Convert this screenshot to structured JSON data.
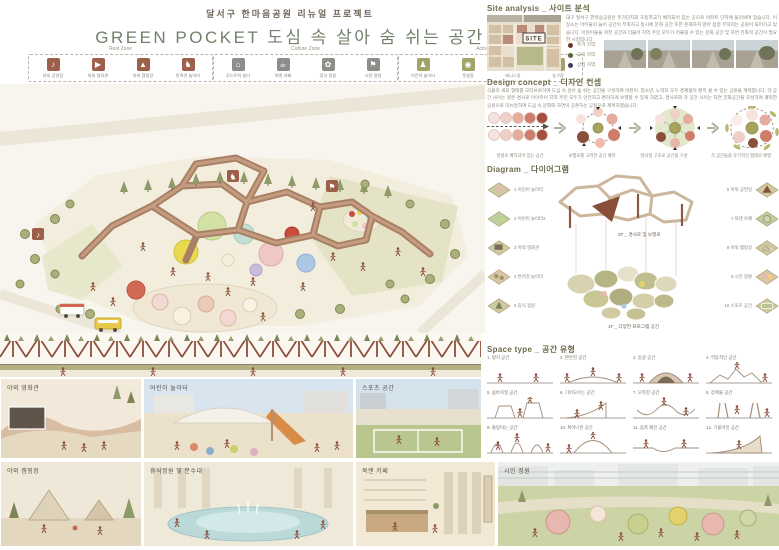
{
  "title": {
    "subtitle": "달서구 한마음공원 리뉴얼 프로젝트",
    "main": "GREEN POCKET  도심 속 살아 숨 쉬는 공간"
  },
  "colors": {
    "title_green": "#72806a",
    "rest_zone_accent": "#9c5f4a",
    "culture_zone_accent": "#8f8d89",
    "activity_zone_accent": "#a3a368",
    "legend_residential": "#6e3430",
    "legend_education": "#55673f",
    "legend_commercial": "#3f4063"
  },
  "zones": [
    {
      "name": "Rest Zone",
      "items": [
        {
          "label": "야외 공연장",
          "glyph": "♪"
        },
        {
          "label": "야외 영화관",
          "glyph": "▶"
        },
        {
          "label": "야외 캠핑장",
          "glyph": "▲"
        },
        {
          "label": "반려견 놀이터",
          "glyph": "♞"
        }
      ]
    },
    {
      "name": "Culture Zone",
      "items": [
        {
          "label": "푸드트럭 쉼터",
          "glyph": "⌂"
        },
        {
          "label": "북앤 카페",
          "glyph": "☕"
        },
        {
          "label": "휴식 정원",
          "glyph": "✿"
        },
        {
          "label": "시민 정원",
          "glyph": "⚑"
        }
      ]
    },
    {
      "name": "Activity Zone",
      "items": [
        {
          "label": "어린이 놀이터",
          "glyph": "♟"
        },
        {
          "label": "풋살장",
          "glyph": "◉"
        },
        {
          "label": "테니스장",
          "glyph": "✶"
        },
        {
          "label": "농구장",
          "glyph": "◍"
        }
      ]
    }
  ],
  "site_analysis": {
    "header": "Site analysis _ 사이트 분석",
    "site_label": "SITE",
    "text": "대구 달서구 한마음공원은 주거단지와 초등학교가 배치되어 있는 곳으로 아파트 단지에 둘러싸여 있습니다. 이 장소는 아이들의 놀이 공간이 부족하고 동시에 문화 공간 또한 존재하지 않아 점점 무뎌지는 공원이 되어가고 있습니다. 어린이들을 위한 공간과 더불어 지역 주민 모두가 어울릴 수 있는 문화 공간 및 자연 친화적 공간이 필요한 시점입니다.",
    "legend": [
      {
        "label": "주거 지역",
        "color": "#6e3430"
      },
      {
        "label": "교육 지역",
        "color": "#55673f"
      },
      {
        "label": "상업 지역",
        "color": "#3f4063"
      }
    ]
  },
  "design_concept": {
    "header": "Design concept _ 디자인 컨셉",
    "text": "식물의 세포 형태를 모티브로하여 도심 속 살아 숨 쉬는 공간을 구성하여 어린이, 청소년, 노약자 모두 경계없이 편히 쉴 수 있는 공원을 계획합니다. 각 공간 사이는 얕은 경사로 이어주어 지역 주민 모두가 안전하고 편리하게 보행할 수 있게 하였고, 경사로와 각 공간 사이는 자연 친화공간을 조성하여 쾌적한 공원으로 리뉴얼하여 도심 속 문화와 자연이 공존하는 공원으로 계획하였습니다.",
    "steps": [
      "일렬로 배치되어 있는 공간",
      "보행로를 고려한 공간 배치",
      "방사형 구조로 공간을 구성",
      "각 공간들을 유기적인 형태로 배열"
    ]
  },
  "diagram": {
    "header": "Diagram _ 다이어그램",
    "floor2": "2F _ 경사로 및 보행로",
    "floor1": "1F _ 다양한 프로그램 공간",
    "left_items": [
      "1 어린이 놀이터",
      "2 어린이 놀이터2",
      "3 야외 영화관",
      "4 반려견 놀이터",
      "5 휴식 정원"
    ],
    "right_items": [
      "6 야외 공연장",
      "7 북앤 카페",
      "8 야외 캠핑장",
      "9 시민 정원",
      "10 스포츠 공간"
    ]
  },
  "space_type": {
    "header": "Space type _ 공간 유형",
    "items": [
      "1. 평지 공간",
      "2. 완만한 공간",
      "3. 동굴 공간",
      "4. 역동적인 공간",
      "5. 숨바꼭질 공간",
      "6. 기어오르는 공간",
      "7. 오목한 공간",
      "8. 장애물 공간",
      "9. 출렁이는 공간",
      "10. 튀어나온 공간",
      "11. 움푹 패인 공간",
      "12. 기울어진 공간"
    ]
  },
  "renders": {
    "row1": [
      "야외 영화관",
      "어린이 놀이터",
      "스포츠 공간"
    ],
    "row2": [
      "야외 캠핑장",
      "휴식정원 및 분수대",
      "북앤 카페"
    ],
    "big": "시민 정원"
  }
}
